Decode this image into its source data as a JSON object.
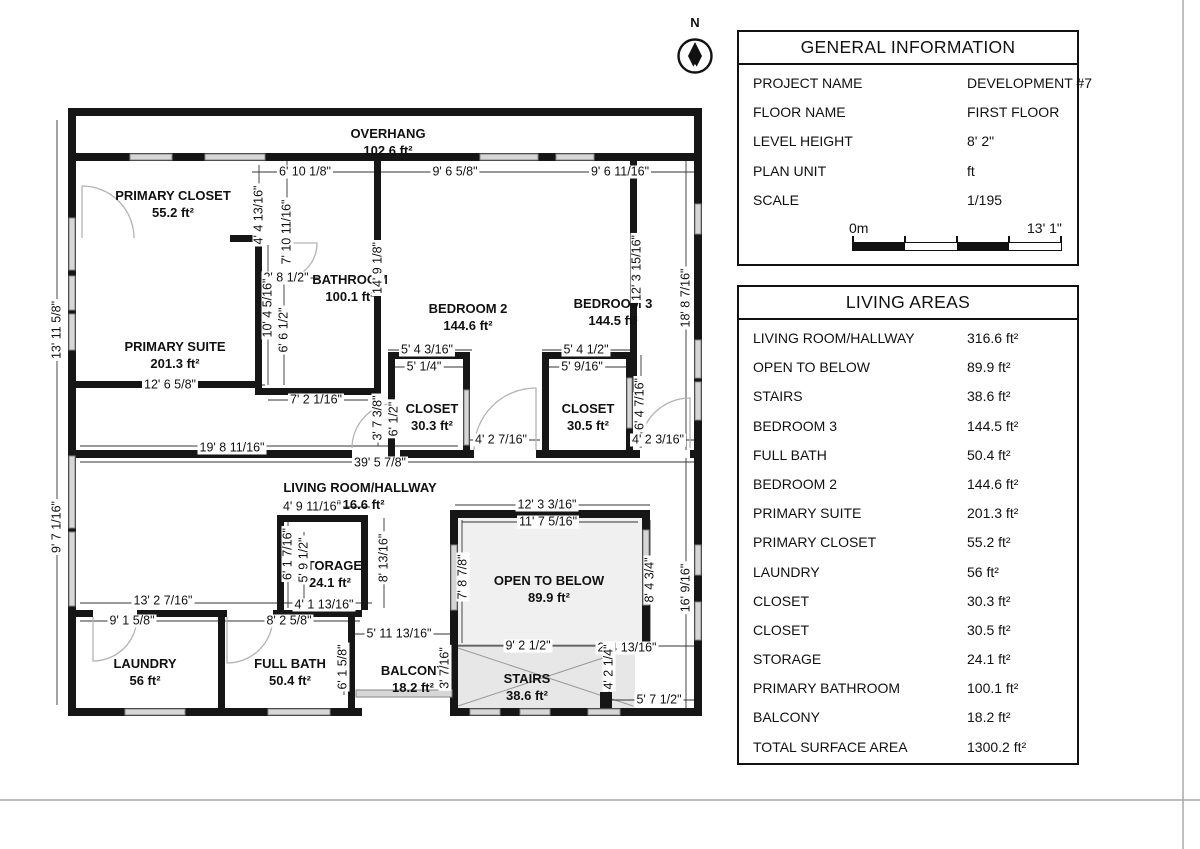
{
  "north": {
    "label": "N"
  },
  "general_info": {
    "title": "GENERAL INFORMATION",
    "rows": [
      {
        "label": "PROJECT NAME",
        "value": "DEVELOPMENT #7"
      },
      {
        "label": "FLOOR NAME",
        "value": "FIRST FLOOR"
      },
      {
        "label": "LEVEL HEIGHT",
        "value": "8' 2\""
      },
      {
        "label": "PLAN UNIT",
        "value": "ft"
      },
      {
        "label": "SCALE",
        "value": "1/195"
      }
    ],
    "scale_bar": {
      "left": "0m",
      "right": "13' 1\""
    }
  },
  "living_areas": {
    "title": "LIVING AREAS",
    "rows": [
      {
        "label": "LIVING ROOM/HALLWAY",
        "value": "316.6 ft²"
      },
      {
        "label": "OPEN TO BELOW",
        "value": "89.9 ft²"
      },
      {
        "label": "STAIRS",
        "value": "38.6 ft²"
      },
      {
        "label": "BEDROOM 3",
        "value": "144.5 ft²"
      },
      {
        "label": "FULL BATH",
        "value": "50.4 ft²"
      },
      {
        "label": "BEDROOM 2",
        "value": "144.6 ft²"
      },
      {
        "label": "PRIMARY SUITE",
        "value": "201.3 ft²"
      },
      {
        "label": "PRIMARY CLOSET",
        "value": "55.2 ft²"
      },
      {
        "label": "LAUNDRY",
        "value": "56 ft²"
      },
      {
        "label": "CLOSET",
        "value": "30.3 ft²"
      },
      {
        "label": "CLOSET",
        "value": "30.5 ft²"
      },
      {
        "label": "STORAGE",
        "value": "24.1 ft²"
      },
      {
        "label": "PRIMARY BATHROOM",
        "value": "100.1 ft²"
      },
      {
        "label": "BALCONY",
        "value": "18.2 ft²"
      },
      {
        "label": "TOTAL SURFACE AREA",
        "value": "1300.2 ft²"
      }
    ]
  },
  "plan": {
    "rooms": [
      {
        "name": "OVERHANG",
        "area": "102.6 ft²",
        "x": 388,
        "y": 142
      },
      {
        "name": "PRIMARY CLOSET",
        "area": "55.2 ft²",
        "x": 173,
        "y": 204
      },
      {
        "name": "PRIMARY SUITE",
        "area": "201.3 ft²",
        "x": 175,
        "y": 355
      },
      {
        "name": "BATHROOM",
        "area": "100.1 ft²",
        "x": 350,
        "y": 288
      },
      {
        "name": "BEDROOM 2",
        "area": "144.6 ft²",
        "x": 468,
        "y": 317
      },
      {
        "name": "BEDROOM 3",
        "area": "144.5 ft²",
        "x": 613,
        "y": 312
      },
      {
        "name": "CLOSET",
        "area": "30.3 ft²",
        "x": 432,
        "y": 417
      },
      {
        "name": "CLOSET",
        "area": "30.5 ft²",
        "x": 588,
        "y": 417
      },
      {
        "name": "LIVING ROOM/HALLWAY",
        "area": "316.6 ft²",
        "x": 360,
        "y": 496
      },
      {
        "name": "STORAGE",
        "area": "24.1 ft²",
        "x": 330,
        "y": 574
      },
      {
        "name": "OPEN TO BELOW",
        "area": "89.9 ft²",
        "x": 549,
        "y": 589
      },
      {
        "name": "LAUNDRY",
        "area": "56 ft²",
        "x": 145,
        "y": 672
      },
      {
        "name": "FULL BATH",
        "area": "50.4 ft²",
        "x": 290,
        "y": 672
      },
      {
        "name": "BALCONY",
        "area": "18.2 ft²",
        "x": 413,
        "y": 679
      },
      {
        "name": "STAIRS",
        "area": "38.6 ft²",
        "x": 527,
        "y": 687
      }
    ],
    "dims": [
      {
        "text": "6' 10 1/8\"",
        "x": 305,
        "y": 172,
        "rot": 0
      },
      {
        "text": "9' 6 5/8\"",
        "x": 455,
        "y": 172,
        "rot": 0
      },
      {
        "text": "9' 6 11/16\"",
        "x": 620,
        "y": 172,
        "rot": 0
      },
      {
        "text": "12' 6 5/8\"",
        "x": 170,
        "y": 385,
        "rot": 0
      },
      {
        "text": "2' 8 1/2\"",
        "x": 286,
        "y": 278,
        "rot": 0
      },
      {
        "text": "7' 2 1/16\"",
        "x": 316,
        "y": 400,
        "rot": 0
      },
      {
        "text": "19' 8 11/16\"",
        "x": 232,
        "y": 448,
        "rot": 0
      },
      {
        "text": "39' 5 7/8\"",
        "x": 380,
        "y": 463,
        "rot": 0
      },
      {
        "text": "5' 4 3/16\"",
        "x": 427,
        "y": 350,
        "rot": 0
      },
      {
        "text": "5' 1/4\"",
        "x": 424,
        "y": 367,
        "rot": 0
      },
      {
        "text": "5' 4 1/2\"",
        "x": 586,
        "y": 350,
        "rot": 0
      },
      {
        "text": "5' 9/16\"",
        "x": 582,
        "y": 367,
        "rot": 0
      },
      {
        "text": "4' 2 7/16\"",
        "x": 501,
        "y": 440,
        "rot": 0
      },
      {
        "text": "4' 2 3/16\"",
        "x": 658,
        "y": 440,
        "rot": 0
      },
      {
        "text": "4' 9 11/16\"",
        "x": 312,
        "y": 507,
        "rot": 0
      },
      {
        "text": "12' 3 3/16\"",
        "x": 547,
        "y": 505,
        "rot": 0
      },
      {
        "text": "11' 7 5/16\"",
        "x": 548,
        "y": 522,
        "rot": 0
      },
      {
        "text": "13' 2 7/16\"",
        "x": 163,
        "y": 601,
        "rot": 0
      },
      {
        "text": "9' 1 5/8\"",
        "x": 132,
        "y": 621,
        "rot": 0
      },
      {
        "text": "8' 2 5/8\"",
        "x": 289,
        "y": 621,
        "rot": 0
      },
      {
        "text": "4' 1 13/16\"",
        "x": 324,
        "y": 605,
        "rot": 0
      },
      {
        "text": "5' 11 13/16\"",
        "x": 399,
        "y": 634,
        "rot": 0
      },
      {
        "text": "9' 2 1/2\"",
        "x": 528,
        "y": 646,
        "rot": 0
      },
      {
        "text": "2' 4 13/16\"",
        "x": 627,
        "y": 648,
        "rot": 0
      },
      {
        "text": "5' 7 1/2\"",
        "x": 659,
        "y": 700,
        "rot": 0
      },
      {
        "text": "4' 4 13/16\"",
        "x": 259,
        "y": 215,
        "rot": -90
      },
      {
        "text": "7' 10 11/16\"",
        "x": 287,
        "y": 232,
        "rot": -90
      },
      {
        "text": "14' 9 1/8\"",
        "x": 378,
        "y": 268,
        "rot": -90
      },
      {
        "text": "12' 3 15/16\"",
        "x": 637,
        "y": 268,
        "rot": -90
      },
      {
        "text": "18' 8 7/16\"",
        "x": 686,
        "y": 298,
        "rot": -90
      },
      {
        "text": "13' 11 5/8\"",
        "x": 57,
        "y": 330,
        "rot": -90
      },
      {
        "text": "10' 4 5/16\"",
        "x": 268,
        "y": 308,
        "rot": -90
      },
      {
        "text": "6' 6 1/2\"",
        "x": 284,
        "y": 330,
        "rot": -90
      },
      {
        "text": "3' 7 3/8\"",
        "x": 378,
        "y": 418,
        "rot": -90
      },
      {
        "text": "6' 1/2\"",
        "x": 394,
        "y": 419,
        "rot": -90
      },
      {
        "text": "6' 4 7/16\"",
        "x": 640,
        "y": 404,
        "rot": -90
      },
      {
        "text": "9' 7 1/16\"",
        "x": 57,
        "y": 527,
        "rot": -90
      },
      {
        "text": "6' 1 7/16\"",
        "x": 288,
        "y": 554,
        "rot": -90
      },
      {
        "text": "5' 9 1/2\"",
        "x": 304,
        "y": 560,
        "rot": -90
      },
      {
        "text": "8' 13/16\"",
        "x": 384,
        "y": 558,
        "rot": -90
      },
      {
        "text": "7' 8 7/8\"",
        "x": 463,
        "y": 577,
        "rot": -90
      },
      {
        "text": "8' 4 3/4\"",
        "x": 650,
        "y": 580,
        "rot": -90
      },
      {
        "text": "16' 9/16\"",
        "x": 686,
        "y": 588,
        "rot": -90
      },
      {
        "text": "6' 1 5/8\"",
        "x": 343,
        "y": 667,
        "rot": -90
      },
      {
        "text": "3' 7/16\"",
        "x": 445,
        "y": 668,
        "rot": -90
      },
      {
        "text": "4' 2 1/4\"",
        "x": 609,
        "y": 667,
        "rot": -90
      }
    ]
  }
}
